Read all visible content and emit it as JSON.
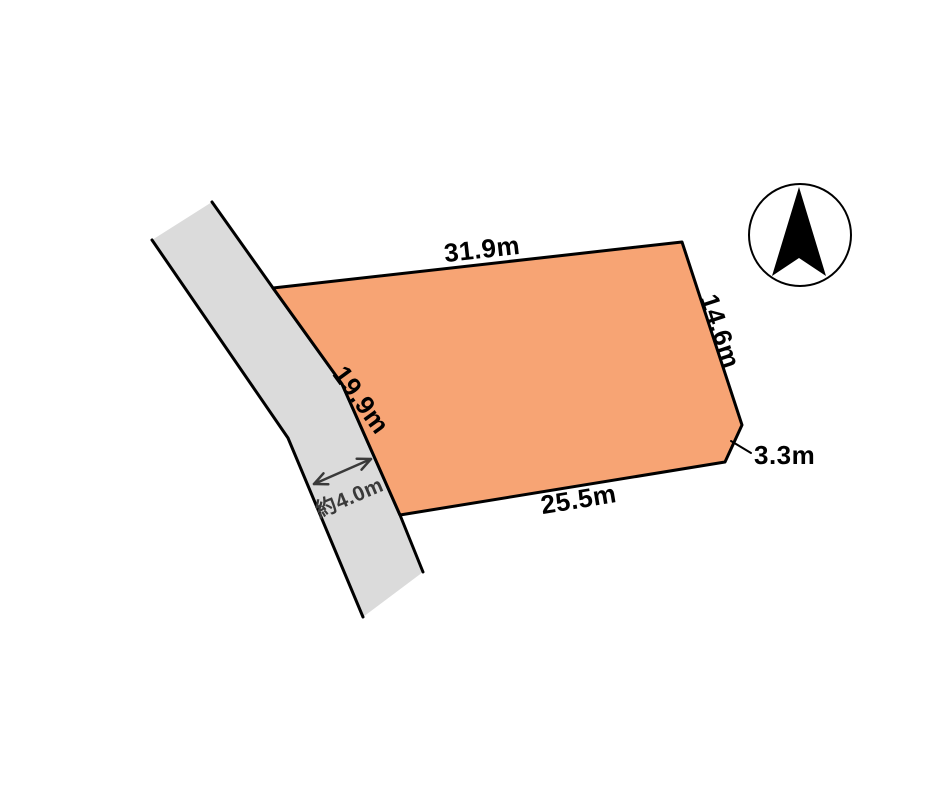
{
  "page": {
    "background": "#ffffff"
  },
  "diagram": {
    "type": "land-plot-site-plan",
    "compass_direction": "north",
    "colors": {
      "plot_fill": "#F7A474",
      "road_fill": "#DBDBDB",
      "outline": "#000000",
      "dimension_text": "#000000",
      "road_arrow": "#3a3a3a",
      "compass_needle": "#000000"
    },
    "dimensions": {
      "top_edge": "31.9m",
      "right_edge": "14.6m",
      "corner_cut": "3.3m",
      "bottom_edge": "25.5m",
      "left_edge": "19.9m",
      "road_width": "約4.0m"
    }
  }
}
